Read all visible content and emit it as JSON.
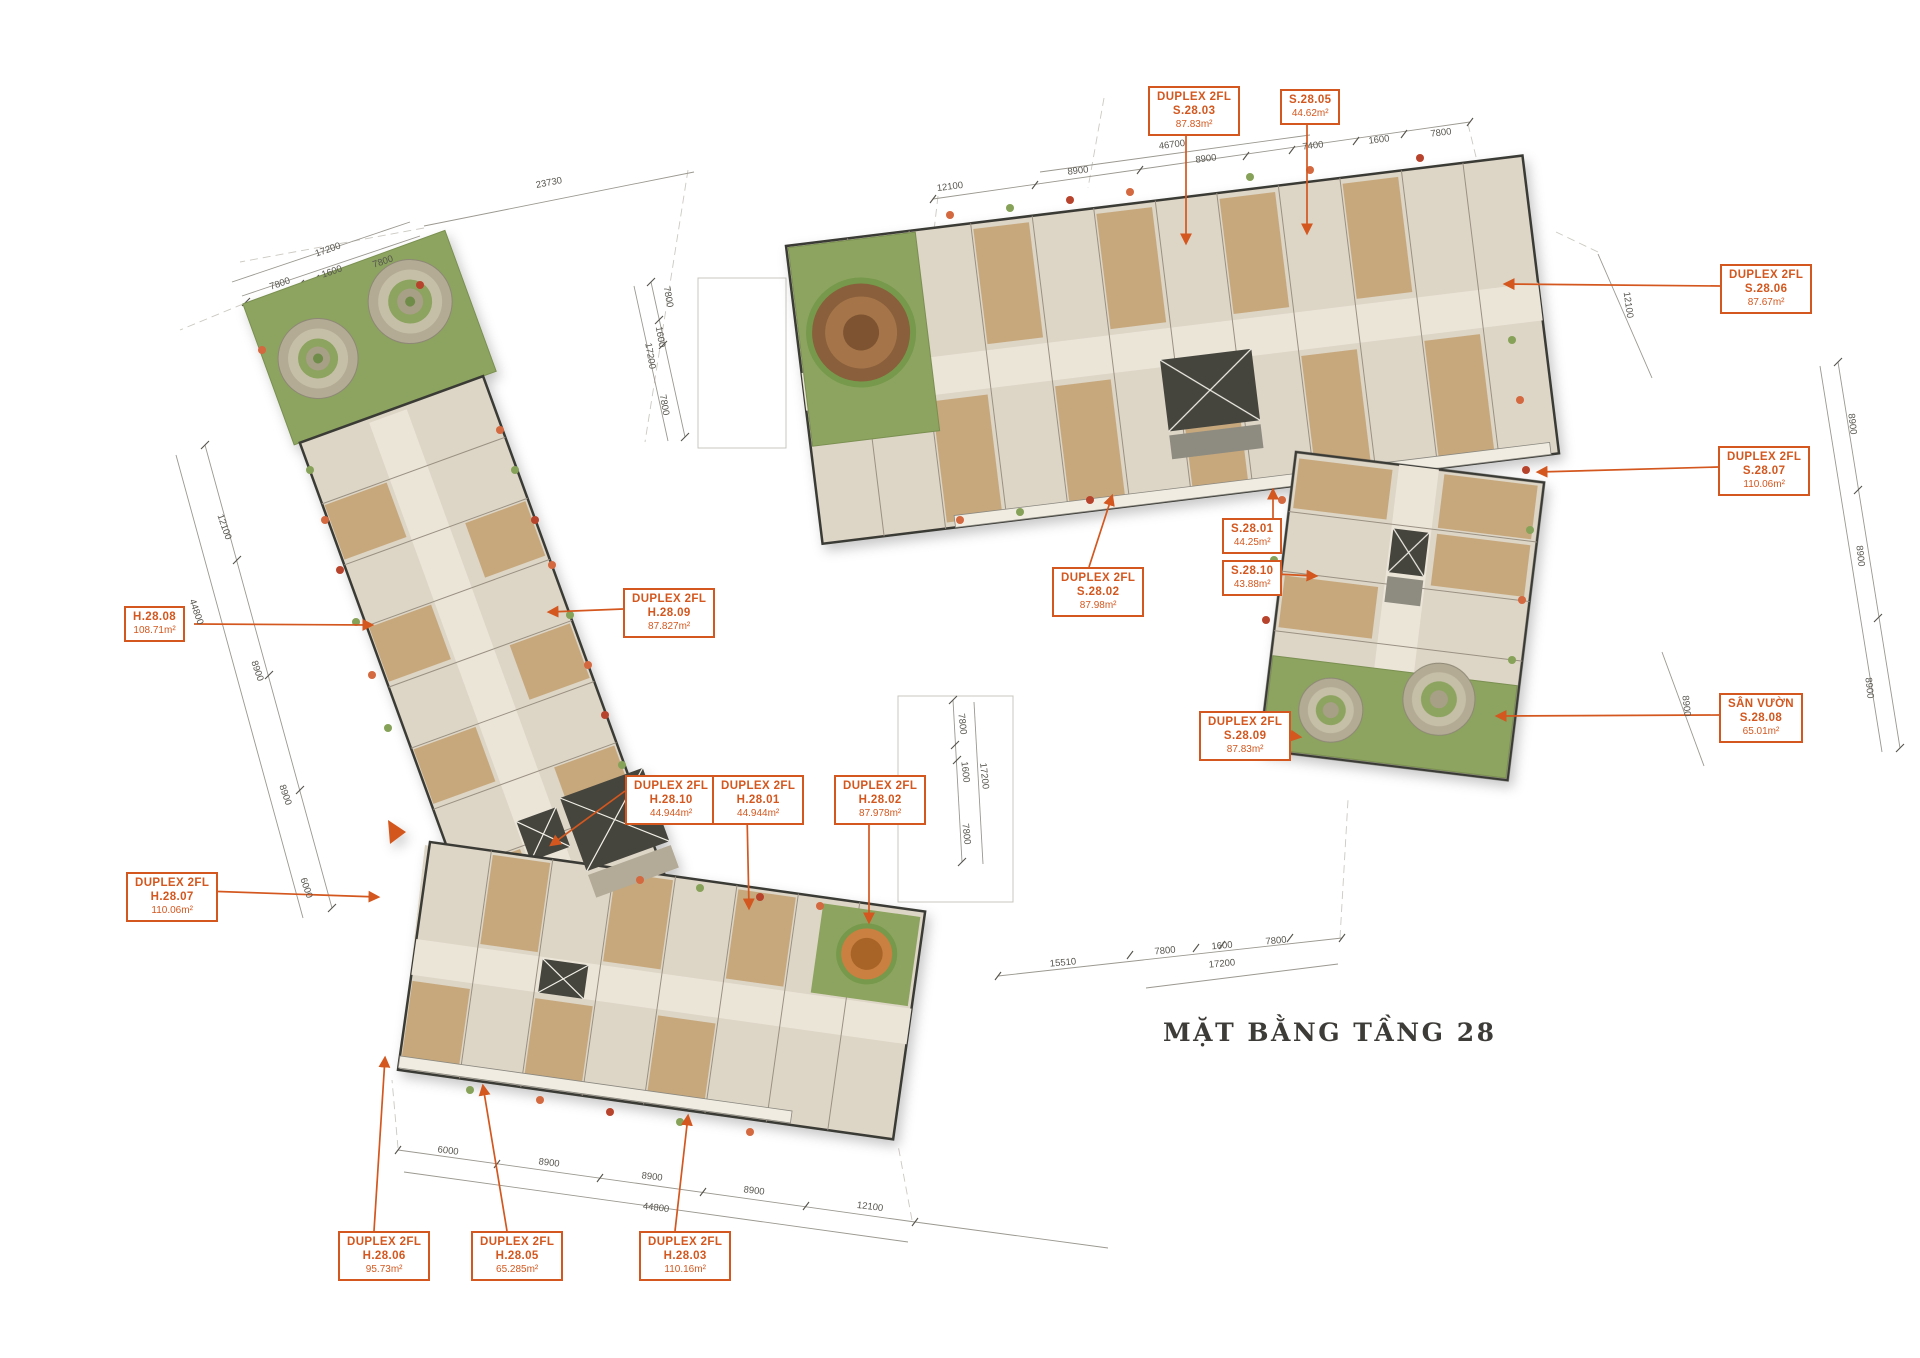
{
  "title": "MẶT BẰNG TẦNG 28",
  "palette": {
    "accent": "#d3571e",
    "wall": "#3b3a36",
    "floor": "#ddd5c6",
    "corridor": "#ebe5d8",
    "wood": "#c7a87d",
    "green": "#8ca45e",
    "dim_text": "#57554e"
  },
  "units": [
    {
      "id": "S.28.03",
      "lines": [
        "DUPLEX 2FL",
        "S.28.03",
        "87.83m²"
      ]
    },
    {
      "id": "S.28.05",
      "lines": [
        "S.28.05",
        "44.62m²"
      ]
    },
    {
      "id": "S.28.06",
      "lines": [
        "DUPLEX 2FL",
        "S.28.06",
        "87.67m²"
      ]
    },
    {
      "id": "S.28.07",
      "lines": [
        "DUPLEX 2FL",
        "S.28.07",
        "110.06m²"
      ]
    },
    {
      "id": "S.28.08",
      "lines": [
        "SÂN VƯỜN",
        "S.28.08",
        "65.01m²"
      ]
    },
    {
      "id": "S.28.09",
      "lines": [
        "DUPLEX 2FL",
        "S.28.09",
        "87.83m²"
      ]
    },
    {
      "id": "S.28.01",
      "lines": [
        "S.28.01",
        "44.25m²"
      ]
    },
    {
      "id": "S.28.10",
      "lines": [
        "S.28.10",
        "43.88m²"
      ]
    },
    {
      "id": "S.28.02",
      "lines": [
        "DUPLEX 2FL",
        "S.28.02",
        "87.98m²"
      ]
    },
    {
      "id": "H.28.08",
      "lines": [
        "H.28.08",
        "108.71m²"
      ]
    },
    {
      "id": "H.28.09",
      "lines": [
        "DUPLEX 2FL",
        "H.28.09",
        "87.827m²"
      ]
    },
    {
      "id": "H.28.10",
      "lines": [
        "DUPLEX 2FL",
        "H.28.10",
        "44.944m²"
      ]
    },
    {
      "id": "H.28.01",
      "lines": [
        "DUPLEX 2FL",
        "H.28.01",
        "44.944m²"
      ]
    },
    {
      "id": "H.28.02",
      "lines": [
        "DUPLEX 2FL",
        "H.28.02",
        "87.978m²"
      ]
    },
    {
      "id": "H.28.07",
      "lines": [
        "DUPLEX 2FL",
        "H.28.07",
        "110.06m²"
      ]
    },
    {
      "id": "H.28.06",
      "lines": [
        "DUPLEX 2FL",
        "H.28.06",
        "95.73m²"
      ]
    },
    {
      "id": "H.28.05",
      "lines": [
        "DUPLEX 2FL",
        "H.28.05",
        "65.285m²"
      ]
    },
    {
      "id": "H.28.03",
      "lines": [
        "DUPLEX 2FL",
        "H.28.03",
        "110.16m²"
      ]
    }
  ],
  "dimensions": [
    {
      "t": "17200",
      "x": 328,
      "y": 250,
      "r": -19
    },
    {
      "t": "7800",
      "x": 280,
      "y": 284,
      "r": -19
    },
    {
      "t": "1600",
      "x": 332,
      "y": 272,
      "r": -19
    },
    {
      "t": "7800",
      "x": 383,
      "y": 262,
      "r": -19
    },
    {
      "t": "23730",
      "x": 549,
      "y": 183,
      "r": -11
    },
    {
      "t": "12100",
      "x": 224,
      "y": 527,
      "r": 71
    },
    {
      "t": "44800",
      "x": 196,
      "y": 612,
      "r": 71
    },
    {
      "t": "8900",
      "x": 257,
      "y": 671,
      "r": 71
    },
    {
      "t": "8900",
      "x": 285,
      "y": 795,
      "r": 71
    },
    {
      "t": "6000",
      "x": 306,
      "y": 888,
      "r": 71
    },
    {
      "t": "12100",
      "x": 950,
      "y": 187,
      "r": -7
    },
    {
      "t": "8900",
      "x": 1078,
      "y": 171,
      "r": -7
    },
    {
      "t": "46700",
      "x": 1172,
      "y": 145,
      "r": -7
    },
    {
      "t": "8900",
      "x": 1206,
      "y": 159,
      "r": -7
    },
    {
      "t": "7400",
      "x": 1313,
      "y": 146,
      "r": -7
    },
    {
      "t": "1600",
      "x": 1379,
      "y": 140,
      "r": -7
    },
    {
      "t": "7800",
      "x": 1441,
      "y": 133,
      "r": -7
    },
    {
      "t": "7800",
      "x": 668,
      "y": 297,
      "r": 80
    },
    {
      "t": "1600",
      "x": 660,
      "y": 337,
      "r": 80
    },
    {
      "t": "17200",
      "x": 650,
      "y": 356,
      "r": 80
    },
    {
      "t": "7800",
      "x": 664,
      "y": 405,
      "r": 80
    },
    {
      "t": "12100",
      "x": 1628,
      "y": 305,
      "r": 82
    },
    {
      "t": "8900",
      "x": 1852,
      "y": 424,
      "r": 84
    },
    {
      "t": "8900",
      "x": 1860,
      "y": 556,
      "r": 84
    },
    {
      "t": "8900",
      "x": 1869,
      "y": 688,
      "r": 84
    },
    {
      "t": "8900",
      "x": 1686,
      "y": 706,
      "r": 84
    },
    {
      "t": "7800",
      "x": 962,
      "y": 724,
      "r": 84
    },
    {
      "t": "1600",
      "x": 965,
      "y": 772,
      "r": 84
    },
    {
      "t": "17200",
      "x": 984,
      "y": 776,
      "r": 84
    },
    {
      "t": "7800",
      "x": 966,
      "y": 834,
      "r": 84
    },
    {
      "t": "6000",
      "x": 448,
      "y": 1151,
      "r": 7
    },
    {
      "t": "8900",
      "x": 549,
      "y": 1163,
      "r": 7
    },
    {
      "t": "8900",
      "x": 652,
      "y": 1177,
      "r": 7
    },
    {
      "t": "8900",
      "x": 754,
      "y": 1191,
      "r": 7
    },
    {
      "t": "44800",
      "x": 656,
      "y": 1208,
      "r": 7
    },
    {
      "t": "12100",
      "x": 870,
      "y": 1207,
      "r": 7
    },
    {
      "t": "15510",
      "x": 1063,
      "y": 963,
      "r": -5
    },
    {
      "t": "7800",
      "x": 1165,
      "y": 951,
      "r": -5
    },
    {
      "t": "1600",
      "x": 1222,
      "y": 946,
      "r": -5
    },
    {
      "t": "7800",
      "x": 1276,
      "y": 941,
      "r": -5
    },
    {
      "t": "17200",
      "x": 1222,
      "y": 964,
      "r": -5
    }
  ]
}
